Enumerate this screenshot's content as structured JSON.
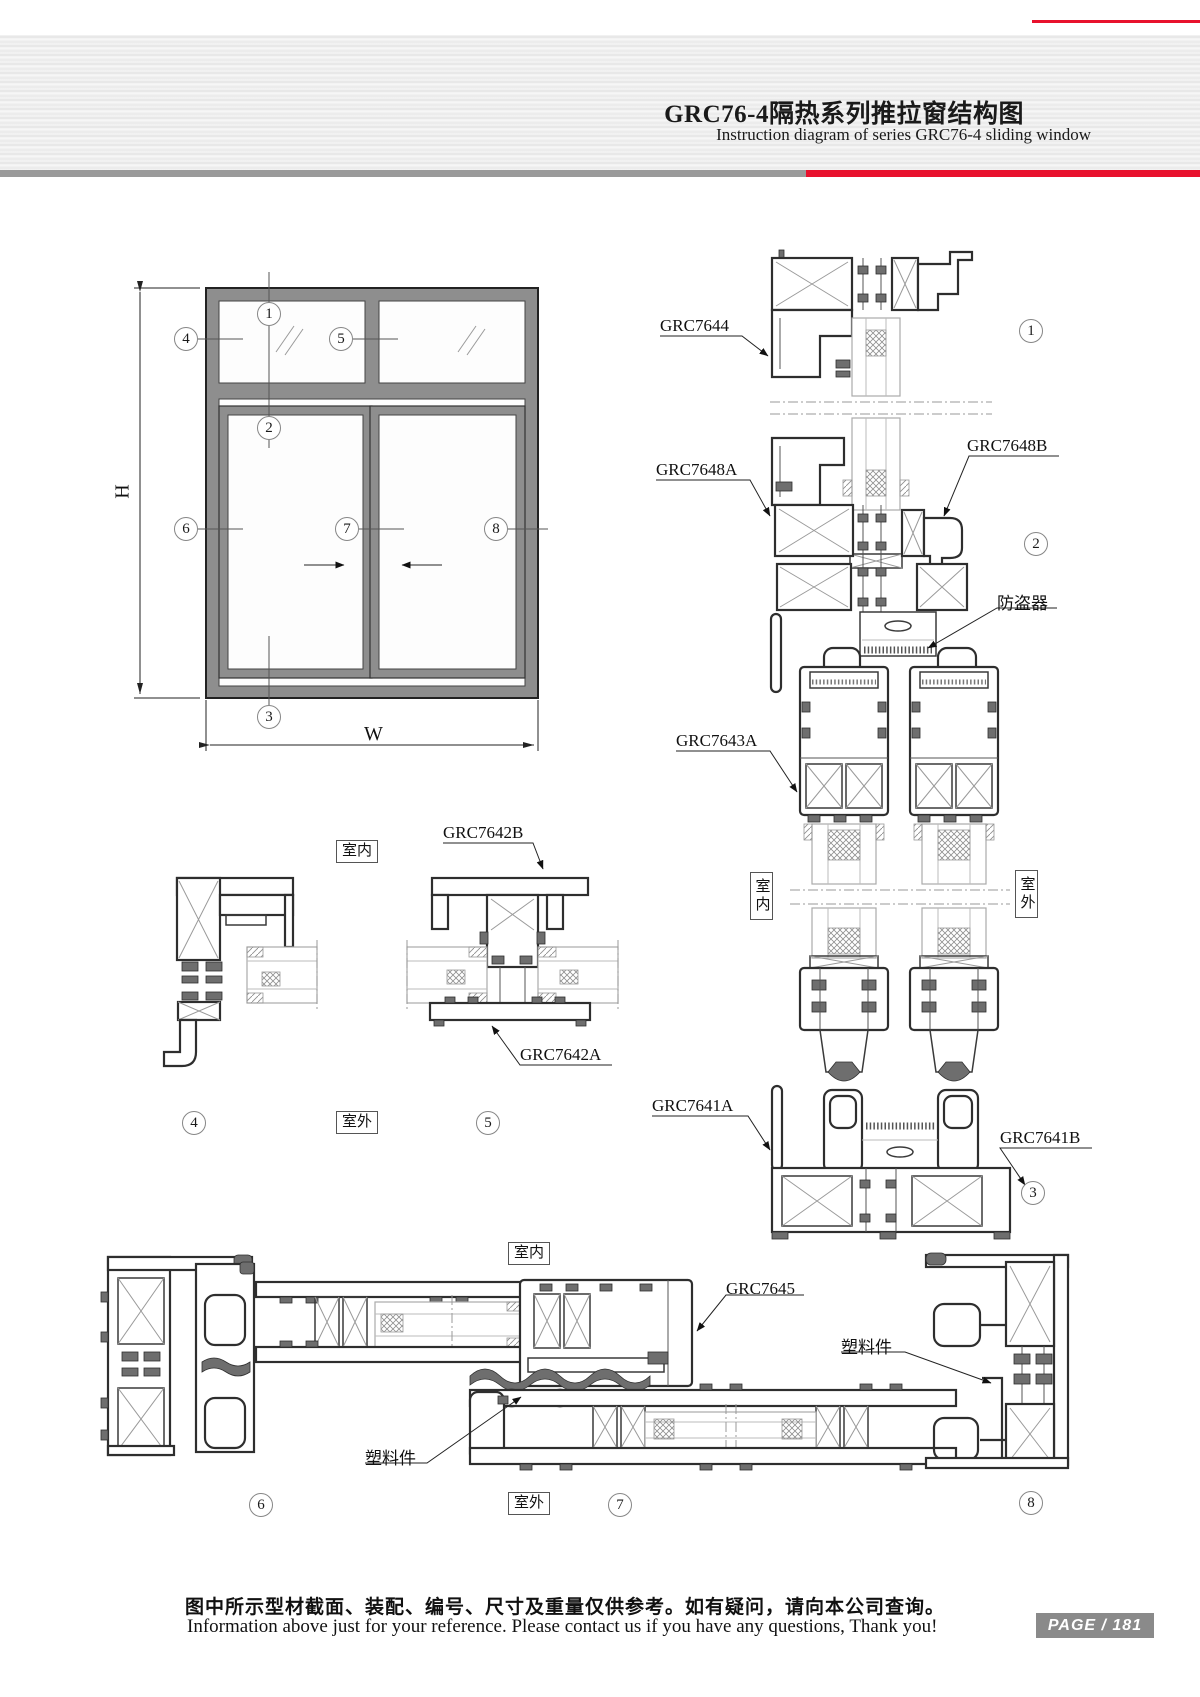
{
  "header": {
    "title_cn": "GRC76-4隔热系列推拉窗结构图",
    "title_en": "Instruction diagram of series GRC76-4 sliding window"
  },
  "callouts": [
    "1",
    "2",
    "3",
    "4",
    "5",
    "6",
    "7",
    "8"
  ],
  "elevation": {
    "dim_h": "H",
    "dim_w": "W"
  },
  "vertical_section": {
    "grc7644": "GRC7644",
    "grc7648a": "GRC7648A",
    "grc7648b": "GRC7648B",
    "anti_theft": "防盗器",
    "grc7643a": "GRC7643A",
    "indoor": "室内",
    "outdoor": "室外",
    "grc7641a": "GRC7641A",
    "grc7641b": "GRC7641B"
  },
  "top_horizontal_section": {
    "indoor": "室内",
    "outdoor": "室外",
    "grc7642b": "GRC7642B",
    "grc7642a": "GRC7642A"
  },
  "bottom_horizontal_section": {
    "indoor": "室内",
    "outdoor": "室外",
    "grc7645": "GRC7645",
    "plastic_left": "塑料件",
    "plastic_right": "塑料件"
  },
  "footer": {
    "note_cn": "图中所示型材截面、装配、编号、尺寸及重量仅供参考。如有疑问，请向本公司查询。",
    "note_en": "Information above just for your reference. Please contact us if you have any questions, Thank you!",
    "page_label": "PAGE / 181"
  }
}
